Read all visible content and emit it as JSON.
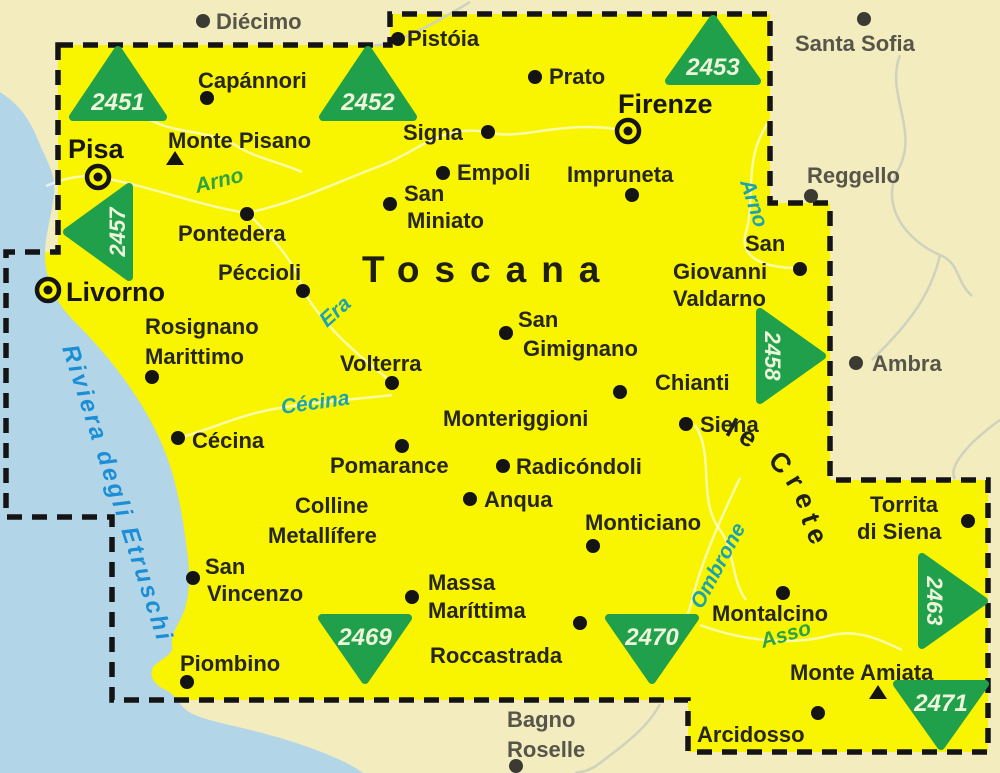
{
  "map": {
    "region_title": "Toscana",
    "area_label": "le Crete",
    "coast_label": "Riviera degli Etruschi"
  },
  "sheets": {
    "s2451": "2451",
    "s2452": "2452",
    "s2453": "2453",
    "s2457": "2457",
    "s2458": "2458",
    "s2463": "2463",
    "s2469": "2469",
    "s2470": "2470",
    "s2471": "2471"
  },
  "rivers": {
    "arno_w": "Arno",
    "arno_e": "Arno",
    "era": "Era",
    "cecina": "Cécina",
    "ombrone": "Ombrone",
    "asso": "Asso"
  },
  "towns": {
    "pisa": "Pisa",
    "firenze": "Firenze",
    "livorno": "Livorno",
    "pistoia": "Pistóia",
    "capannori": "Capánnori",
    "prato": "Prato",
    "signa": "Signa",
    "empoli": "Empoli",
    "impruneta": "Impruneta",
    "san_miniato_1": "San",
    "san_miniato_2": "Miniato",
    "monte_pisano": "Monte Pisano",
    "pontedera": "Pontedera",
    "peccioli": "Péccioli",
    "rosignano_1": "Rosignano",
    "rosignano_2": "Marittimo",
    "volterra": "Volterra",
    "san_gimignano_1": "San",
    "san_gimignano_2": "Gimignano",
    "monteriggioni": "Monteriggioni",
    "chianti": "Chianti",
    "siena": "Siena",
    "sgv_1": "San",
    "sgv_2": "Giovanni",
    "sgv_3": "Valdarno",
    "cecina_town": "Cécina",
    "pomarance": "Pomarance",
    "radicondoli": "Radicóndoli",
    "anqua": "Anqua",
    "colline_1": "Colline",
    "colline_2": "Metallífere",
    "monticiano": "Monticiano",
    "torrita_1": "Torrita",
    "torrita_2": "di Siena",
    "san_vincenzo_1": "San",
    "san_vincenzo_2": "Vincenzo",
    "massa_1": "Massa",
    "massa_2": "Maríttima",
    "montalcino": "Montalcino",
    "roccastrada": "Roccastrada",
    "piombino": "Piombino",
    "monte_amiata": "Monte Amiata",
    "arcidosso": "Arcidosso"
  },
  "outside_towns": {
    "diecimo": "Diécimo",
    "santa_sofia": "Santa Sofia",
    "reggello": "Reggello",
    "ambra": "Ambra",
    "bagno_1": "Bagno",
    "bagno_2": "Roselle"
  },
  "colors": {
    "map_area_yellow": "#f9f400",
    "outside_land_cream": "#f2ecbf",
    "sea_blue": "#b2d6e8",
    "sheet_triangle_green": "#21a04c",
    "river_label_teal": "#1ba3ad",
    "river_label_green": "#2fa343",
    "coast_label_blue": "#1b8ed6",
    "border_black": "#141414"
  }
}
